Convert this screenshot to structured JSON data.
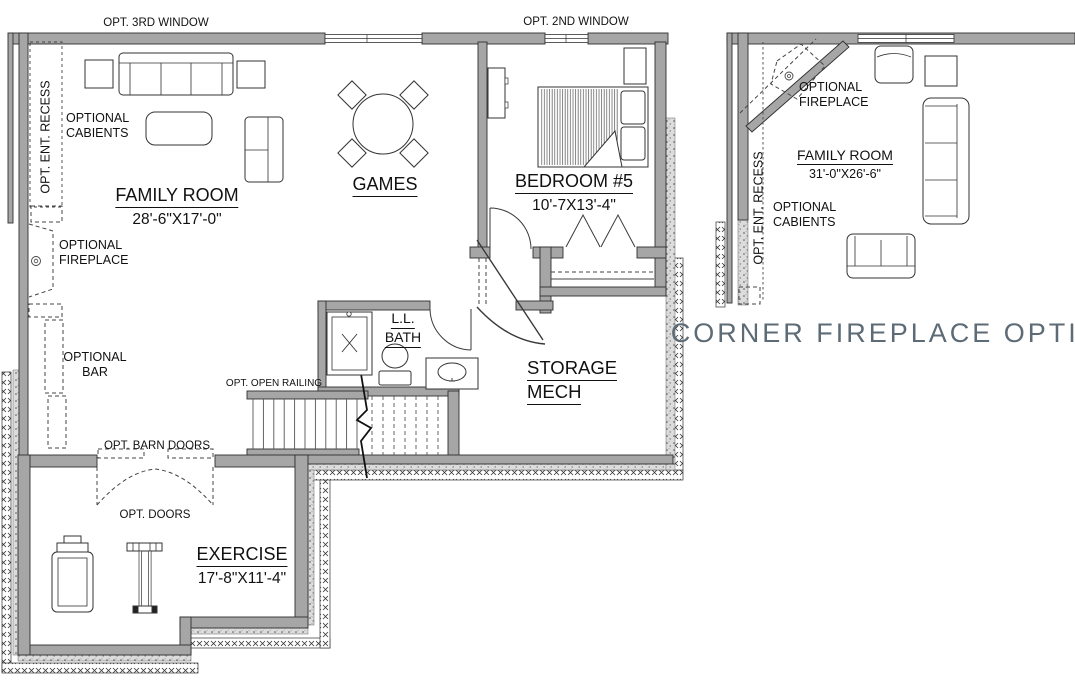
{
  "title": "Lower level floor plan",
  "colors": {
    "wall_gray": "#a6a6a6",
    "line_dark": "#2f2f2f",
    "caption_slate": "#5c6b76"
  },
  "main_plan": {
    "opt_third_window": "OPT. 3RD WINDOW",
    "opt_second_window": "OPT. 2ND WINDOW",
    "entry_recess": "OPT. ENT. RECESS",
    "cabinets_line1": "OPTIONAL",
    "cabinets_line2": "CABIENTS",
    "family_room": {
      "name": "FAMILY ROOM",
      "dims": "28'-6\"X17'-0\""
    },
    "games": {
      "name": "GAMES"
    },
    "bedroom5": {
      "name": "BEDROOM #5",
      "dims": "10'-7X13'-4\""
    },
    "fireplace_line1": "OPTIONAL",
    "fireplace_line2": "FIREPLACE",
    "bar_line1": "OPTIONAL",
    "bar_line2": "BAR",
    "open_railing": "OPT. OPEN RAILING",
    "bath_line1": "L.L.",
    "bath_line2": "BATH",
    "storage_line1": "STORAGE",
    "storage_line2": "MECH",
    "barn_doors": "OPT. BARN DOORS",
    "opt_doors": "OPT. DOORS",
    "exercise": {
      "name": "EXERCISE",
      "dims": "17'-8\"X11'-4\""
    }
  },
  "inset_plan": {
    "fireplace_line1": "OPTIONAL",
    "fireplace_line2": "FIREPLACE",
    "family_room": {
      "name": "FAMILY ROOM",
      "dims": "31'-0\"X26'-6\""
    },
    "entry_recess": "OPT. ENT. RECESS",
    "cabinets_line1": "OPTIONAL",
    "cabinets_line2": "CABIENTS",
    "caption": "CORNER FIREPLACE OPTION"
  }
}
